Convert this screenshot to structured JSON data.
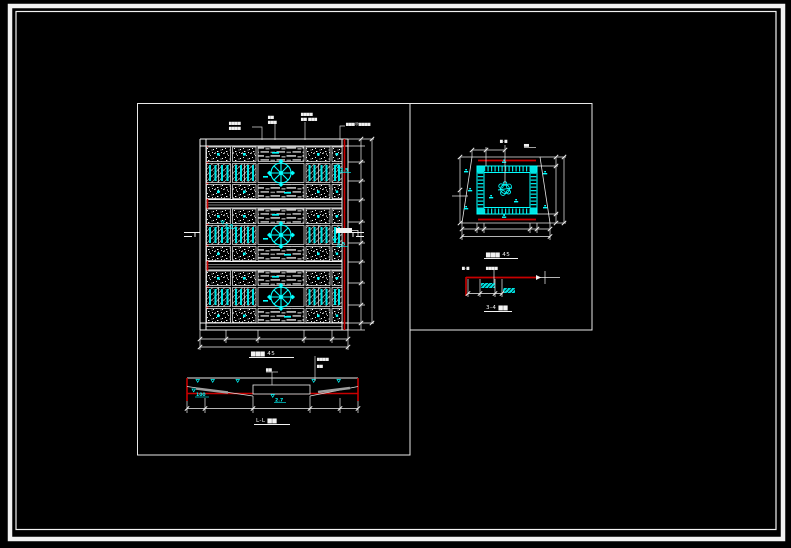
{
  "palette": {
    "background": "#000000",
    "line_white": "#f2f2f2",
    "line_red": "#c80000",
    "line_cyan": "#00ffff",
    "hatch_gray": "#a8a8a8"
  },
  "plan": {
    "title": "▆▆▆ 45",
    "callouts": {
      "c1a": "▆▆▆▆",
      "c1b": "▆▆▆▆",
      "c2a": "▆▆",
      "c2b": "▆▆▆",
      "c3a": "▆▆▆▆",
      "c3b": "▆▆ ▆▆▆",
      "c4": "▆▆▆@▆▆▆▆"
    },
    "elevations": {
      "band1_right": "2.5",
      "band2_left": "2.5",
      "band2_right": "2.5"
    }
  },
  "detail": {
    "title": "▆▆▆ 45",
    "top_label": "▆-▆",
    "top_tag": "▆▆"
  },
  "section_a": {
    "title": "3-4 ▆▆",
    "label_left": "▆-▆",
    "label_right": "▆▆▆▆"
  },
  "section_l": {
    "title": "L-L ▆▆",
    "label_center": "▆▆",
    "label_right_a": "▆▆▆▆",
    "label_right_b": "▆▆",
    "elev_left": "100",
    "elev_center": "2.7"
  }
}
